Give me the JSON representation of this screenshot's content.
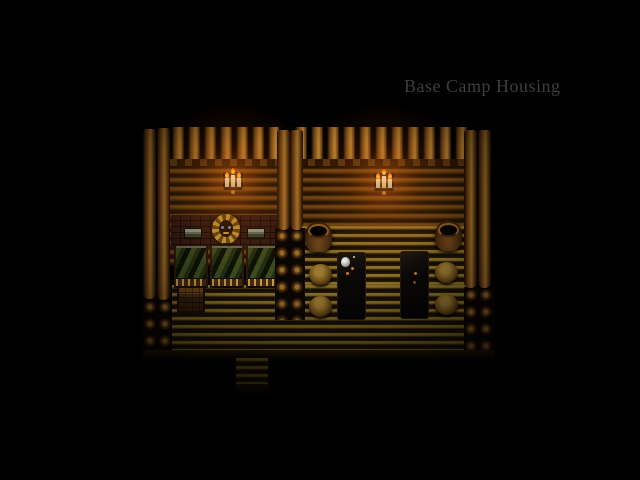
{
  "window": {
    "width": 640,
    "height": 480,
    "background": "#000000"
  },
  "overlay_text": {
    "location_label": "Base Camp Housing",
    "color": "#3e3e3e"
  },
  "scene": {
    "name": "log-cabin-interior",
    "rooms": [
      {
        "name": "bunk-room",
        "objects": [
          "wall-candelabra",
          "lion-emblem",
          "shuttered-window",
          "shuttered-window",
          "bed",
          "bed",
          "bed",
          "chest"
        ]
      },
      {
        "name": "mess-room",
        "objects": [
          "wall-candelabra",
          "barrel",
          "barrel",
          "table",
          "table",
          "stool",
          "stool",
          "stool",
          "stool",
          "mug"
        ]
      }
    ],
    "exit": "south-corridor",
    "counts": {
      "beds": 3,
      "tables": 2,
      "stools": 4,
      "barrels": 2,
      "candelabras": 2,
      "windows": 2
    },
    "palette": {
      "void": "#000000",
      "log_highlight": "#a87428",
      "log_mid": "#6a4416",
      "log_dark": "#1c1005",
      "floor_light": "#8a7226",
      "floor_dark": "#1a1206",
      "brick_wall": "#301811",
      "blanket_green": "#39471c",
      "candle_white": "#d8d2bc",
      "flame_orange": "#ff8c14",
      "emblem_gold": "#b8922c",
      "emblem_eye_blue": "#5a8ac8",
      "window_teal": "#6a7a68",
      "glow_warm": "rgba(255,140,30,0.3)"
    }
  }
}
